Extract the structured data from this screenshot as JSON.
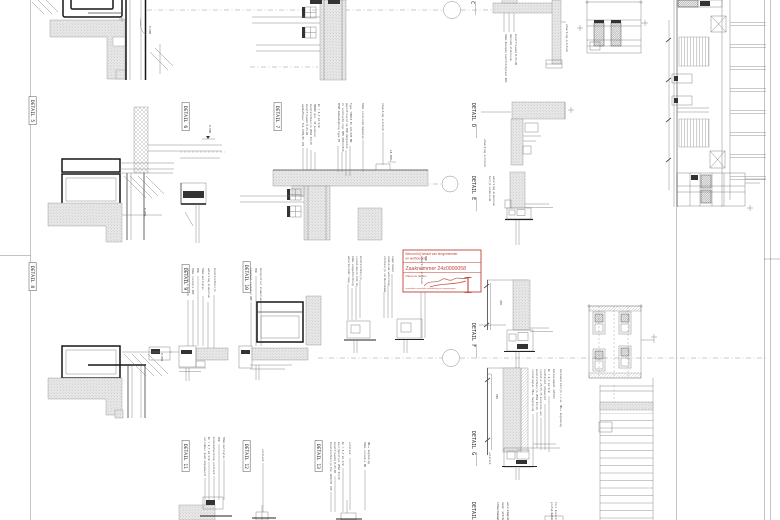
{
  "sheet": {
    "background": "#ffffff",
    "line_color": "#7a7a7a",
    "dark_line_color": "#161616",
    "accent_red": "#c0423c"
  },
  "stamp": {
    "line1": "Behoort bij besluit van burgemeester",
    "line2": "en wethouders",
    "case_number": "Zaaknummer 24z0000058",
    "salutation": "Namens dezen,",
    "footer": "teamleider ruimtelijke ontwikkeling en vergunningen"
  },
  "detail_labels": [
    {
      "label": "DETAIL 5",
      "x": 31,
      "y": 100,
      "boxed": true
    },
    {
      "label": "DETAIL 6",
      "x": 184,
      "y": 106,
      "boxed": true
    },
    {
      "label": "DETAIL 7",
      "x": 276,
      "y": 106,
      "boxed": true
    },
    {
      "label": "DETAIL 8",
      "x": 31,
      "y": 266,
      "boxed": true
    },
    {
      "label": "DETAIL 9",
      "x": 184,
      "y": 268,
      "boxed": true
    },
    {
      "label": "DETAIL 10",
      "x": 245,
      "y": 265,
      "boxed": true
    },
    {
      "label": "DETAIL 11",
      "x": 184,
      "y": 444,
      "boxed": true
    },
    {
      "label": "DETAIL 12",
      "x": 245,
      "y": 444,
      "boxed": true
    },
    {
      "label": "DETAIL 13",
      "x": 317,
      "y": 444,
      "boxed": true
    },
    {
      "label": "DETAIL C",
      "x": 471,
      "y": -20,
      "boxed": false
    },
    {
      "label": "DETAIL D",
      "x": 472,
      "y": 103,
      "boxed": false
    },
    {
      "label": "DETAIL E",
      "x": 472,
      "y": 176,
      "boxed": false
    },
    {
      "label": "DETAIL F",
      "x": 472,
      "y": 323,
      "boxed": false
    },
    {
      "label": "DETAIL G",
      "x": 472,
      "y": 431,
      "boxed": false
    },
    {
      "label": "DETAIL H",
      "x": 472,
      "y": 502,
      "boxed": false
    }
  ],
  "levels": [
    {
      "x": 149,
      "y": 26,
      "text": "0.000"
    },
    {
      "x": 144,
      "y": 208,
      "text": "0.050-"
    },
    {
      "x": 209,
      "y": 125,
      "text": "0.000"
    },
    {
      "x": 161,
      "y": 353,
      "text": "0.050-"
    },
    {
      "x": 390,
      "y": 150,
      "text": "18.500+"
    }
  ],
  "dims": [
    {
      "x": 500,
      "y": 300,
      "text": "200"
    },
    {
      "x": 496,
      "y": 394,
      "text": "200"
    }
  ],
  "annotations": [
    {
      "x": 302,
      "y": 104,
      "text": "wandafbouw: Fuk 1000/05 100"
    },
    {
      "x": 306,
      "y": 104,
      "text": "kunstfilwand B-03-DO"
    },
    {
      "x": 310,
      "y": 104,
      "text": "kunststofkozijn VEKA 82/20"
    },
    {
      "x": 314,
      "y": 104,
      "text": "HWDBO min. 30 minuten"
    },
    {
      "x": 318,
      "y": 104,
      "text": "Rc = 4,7 m2 K/W"
    },
    {
      "x": 338,
      "y": 103,
      "text": "EPDM dakbedekking type FB"
    },
    {
      "x": 342,
      "y": 103,
      "text": "2x verkleefd vlgs NEN 6063/2019"
    },
    {
      "x": 346,
      "y": 103,
      "text": "geprofileerd op PUR dakplaten"
    },
    {
      "x": 350,
      "y": 103,
      "text": "type 'HERTA PS 125/180 MW'"
    },
    {
      "x": 362,
      "y": 103,
      "text": "50mm isolerend dakbeton"
    },
    {
      "x": 382,
      "y": 103,
      "text": "afwerking uitstuck"
    },
    {
      "x": 505,
      "y": 34,
      "text": "20mm Resopan kunststofplaat ABS"
    },
    {
      "x": 510,
      "y": 34,
      "text": "dakrand aluminium"
    },
    {
      "x": 515,
      "y": 34,
      "text": "kunstfilwand B-03-DO"
    },
    {
      "x": 566,
      "y": 24,
      "text": "afwerking uitstuck"
    },
    {
      "x": 484,
      "y": 139,
      "text": "afwerking uitstuck"
    },
    {
      "x": 489,
      "y": 176,
      "text": "kozijn aluminium"
    },
    {
      "x": 493,
      "y": 176,
      "text": "waterslag aluminium"
    },
    {
      "x": 532,
      "y": 369,
      "text": "isolatieglas HR++ beglazing"
    },
    {
      "x": 536,
      "y": 369,
      "text": "kunststofkozijn VEKA 82/20"
    },
    {
      "x": 540,
      "y": 369,
      "text": "isolatie 75/15-75 minerale wol"
    },
    {
      "x": 544,
      "y": 369,
      "text": "luchtdicht afgewerkt"
    },
    {
      "x": 548,
      "y": 369,
      "text": "Rc = 4,7 m2 K/W"
    },
    {
      "x": 553,
      "y": 369,
      "text": "betonelement aGF162"
    },
    {
      "x": 560,
      "y": 369,
      "text": "bestaand kozijn i.v.m. HR++ beglazing"
    },
    {
      "x": 489,
      "y": 452,
      "text": "uitstuck"
    },
    {
      "x": 187,
      "y": 268,
      "text": "afwerking uitstuck"
    },
    {
      "x": 192,
      "y": 268,
      "text": "50mm isolatie ABP"
    },
    {
      "x": 197,
      "y": 268,
      "text": "PUR"
    },
    {
      "x": 202,
      "y": 268,
      "text": "50mm multiplex"
    },
    {
      "x": 208,
      "y": 268,
      "text": "waterslag aluminium"
    },
    {
      "x": 214,
      "y": 268,
      "text": "kunststofkozijn"
    },
    {
      "x": 250,
      "y": 268,
      "text": "steenwol isolatie ABP"
    },
    {
      "x": 255,
      "y": 268,
      "text": "PUR"
    },
    {
      "x": 260,
      "y": 268,
      "text": "knelprofiel aluminium"
    },
    {
      "x": 348,
      "y": 256,
      "text": "waterkerende laag"
    },
    {
      "x": 352,
      "y": 256,
      "text": "10mm voegafdichting"
    },
    {
      "x": 356,
      "y": 256,
      "text": "isolatiekern U=0,16"
    },
    {
      "x": 360,
      "y": 256,
      "text": "kunststofkozijn"
    },
    {
      "x": 384,
      "y": 256,
      "text": "stelkozijn verduurzaamd"
    },
    {
      "x": 388,
      "y": 256,
      "text": "aluminium waterslag"
    },
    {
      "x": 392,
      "y": 256,
      "text": "compriband"
    },
    {
      "x": 421,
      "y": 256,
      "text": "afwerking uitstuck"
    },
    {
      "x": 425,
      "y": 256,
      "text": "PUR"
    },
    {
      "x": 204,
      "y": 437,
      "text": "celrubber band afgesmeerd"
    },
    {
      "x": 208,
      "y": 437,
      "text": "Rc = 4,7 m2 K/W"
    },
    {
      "x": 213,
      "y": 437,
      "text": "binnenafwerking uitstuck"
    },
    {
      "x": 218,
      "y": 437,
      "text": "PUR"
    },
    {
      "x": 223,
      "y": 437,
      "text": "50mm multiplex"
    },
    {
      "x": 262,
      "y": 449,
      "text": "uitstuck"
    },
    {
      "x": 330,
      "y": 442,
      "text": "kunststofkozijn Fuk 1000/05 100"
    },
    {
      "x": 334,
      "y": 442,
      "text": "kunstfilwand B-03-DO"
    },
    {
      "x": 338,
      "y": 442,
      "text": "kozijnprofiel VEKA 82/20"
    },
    {
      "x": 342,
      "y": 442,
      "text": "Rc = 4,7 m2 K/W"
    },
    {
      "x": 349,
      "y": 442,
      "text": "uitstuck"
    },
    {
      "x": 364,
      "y": 442,
      "text": "50mm isolatie MW"
    },
    {
      "x": 368,
      "y": 442,
      "text": "HR++ beglazing"
    },
    {
      "x": 497,
      "y": 502,
      "text": "100mm kanaalplaatvloer"
    },
    {
      "x": 502,
      "y": 502,
      "text": "nader uit te werken"
    },
    {
      "x": 507,
      "y": 502,
      "text": "waterslag aluminium"
    },
    {
      "x": 551,
      "y": 502,
      "text": "prefab betonband"
    },
    {
      "x": 555,
      "y": 502,
      "text": "Torx bevestiging"
    }
  ]
}
